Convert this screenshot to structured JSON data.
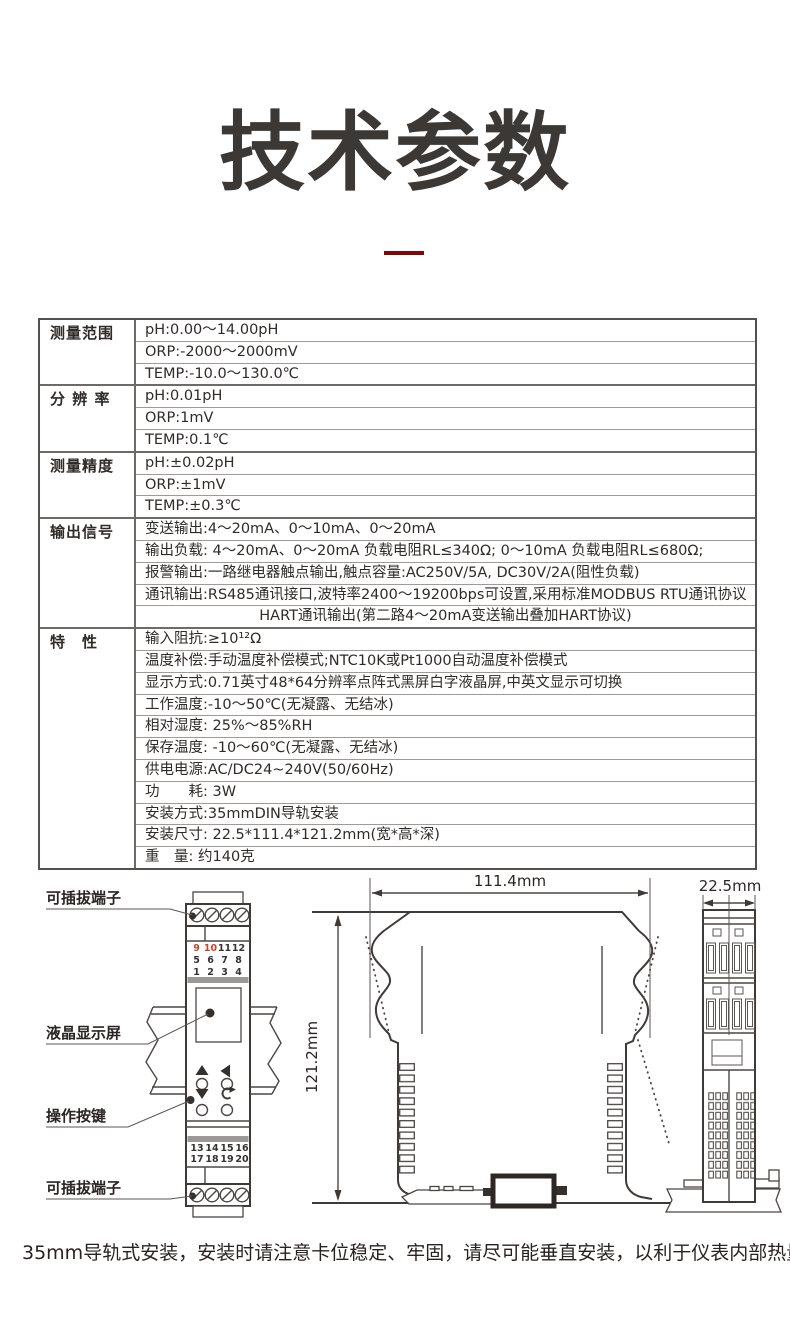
{
  "page": {
    "title": "技术参数",
    "accent_color": "#7f0509",
    "footer_note": "35mm导轨式安装，安装时请注意卡位稳定、牢固，请尽可能垂直安装，以利于仪表内部热量散发。"
  },
  "spec_table": {
    "groups": [
      {
        "label": "测量范围",
        "rows": [
          {
            "text": "pH:0.00～14.00pH"
          },
          {
            "text": "ORP:-2000～2000mV"
          },
          {
            "text": "TEMP:-10.0～130.0℃"
          }
        ]
      },
      {
        "label": "分 辨 率",
        "rows": [
          {
            "text": "pH:0.01pH"
          },
          {
            "text": "ORP:1mV"
          },
          {
            "text": "TEMP:0.1℃"
          }
        ]
      },
      {
        "label": "测量精度",
        "rows": [
          {
            "text": "pH:±0.02pH"
          },
          {
            "text": "ORP:±1mV"
          },
          {
            "text": "TEMP:±0.3℃"
          }
        ]
      },
      {
        "label": "输出信号",
        "rows": [
          {
            "text": "变送输出:4～20mA、0～10mA、0～20mA"
          },
          {
            "text": "输出负载: 4～20mA、0～20mA 负载电阻RL≤340Ω; 0～10mA 负载电阻RL≤680Ω;"
          },
          {
            "text": "报警输出:一路继电器触点输出,触点容量:AC250V/5A, DC30V/2A(阻性负载)"
          },
          {
            "text": "通讯输出:RS485通讯接口,波特率2400～19200bps可设置,采用标准MODBUS RTU通讯协议"
          },
          {
            "text": "HART通讯输出(第二路4～20mA变送输出叠加HART协议)",
            "align": "center"
          }
        ]
      },
      {
        "label": "特　性",
        "rows": [
          {
            "text": "输入阻抗:≥10¹²Ω"
          },
          {
            "text": "温度补偿:手动温度补偿模式;NTC10K或Pt1000自动温度补偿模式"
          },
          {
            "text": "显示方式:0.71英寸48*64分辨率点阵式黑屏白字液晶屏,中英文显示可切换"
          },
          {
            "text": "工作温度:-10～50℃(无凝露、无结冰)"
          },
          {
            "text": "相对湿度: 25%～85%RH"
          },
          {
            "text": "保存温度: -10～60℃(无凝露、无结冰)"
          },
          {
            "text": "供电电源:AC/DC24~240V(50/60Hz)"
          },
          {
            "text": "功　　耗: 3W"
          },
          {
            "text": "安装方式:35mmDIN导轨安装"
          },
          {
            "text": "安装尺寸: 22.5*111.4*121.2mm(宽*高*深)"
          },
          {
            "text": "重　量: 约140克"
          }
        ]
      }
    ]
  },
  "diagrams": {
    "front_view": {
      "label_top_terminal": "可插拔端子",
      "label_lcd": "液晶显示屏",
      "label_buttons": "操作按键",
      "label_bottom_terminal": "可插拔端子",
      "terminal_numbers_top": [
        [
          "9",
          "10",
          "11",
          "12"
        ],
        [
          "5",
          "6",
          "7",
          "8"
        ],
        [
          "1",
          "2",
          "3",
          "4"
        ]
      ],
      "red_terminal_numbers": [
        "9",
        "10"
      ],
      "terminal_numbers_bottom": [
        [
          "13",
          "14",
          "15",
          "16"
        ],
        [
          "17",
          "18",
          "19",
          "20"
        ]
      ],
      "terminal_red_color": "#c8452c"
    },
    "outline_view": {
      "width_label": "111.4mm",
      "height_label": "121.2mm"
    },
    "side_view": {
      "width_label": "22.5mm"
    }
  }
}
